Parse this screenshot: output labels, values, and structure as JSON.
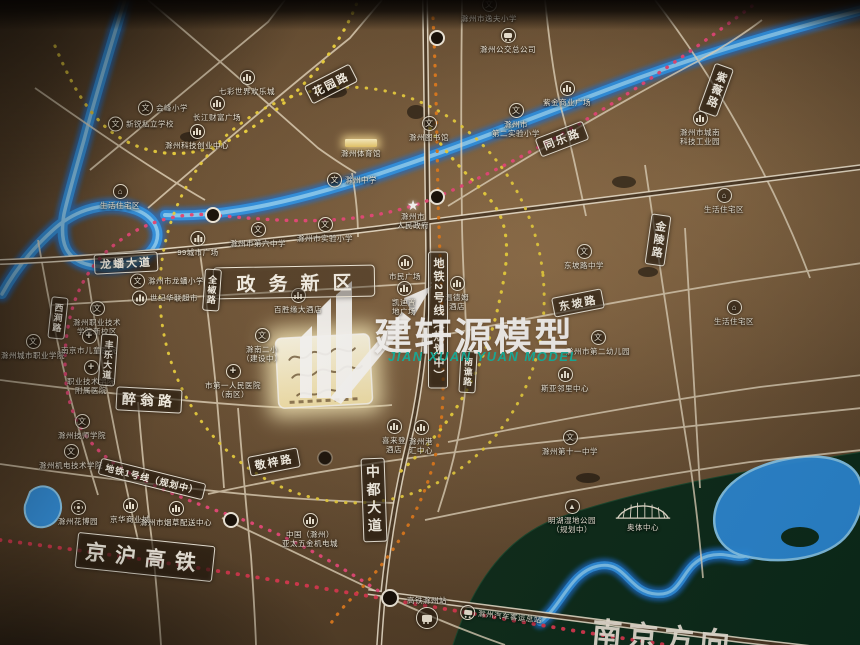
{
  "watermark": {
    "title": "建轩源模型",
    "subtitle": "JIAN XUAN YUAN MODEL",
    "accent_color": "#14b5a2"
  },
  "map": {
    "district_label": "政务新区",
    "direction_label": "南京方向",
    "colors": {
      "board_brown": "#6b5238",
      "road_line": "#eee2c9",
      "river_blue": "#2f93e6",
      "park_green": "#0d2d1c",
      "metro_yellow": "#ecd23e",
      "rail_pink": "#e8487a",
      "hsr_red": "#d93850",
      "line_orange": "#e07b1e",
      "glow_parcel": "#fff3cf"
    },
    "road_labels": [
      {
        "text": "花园路",
        "x": 331,
        "y": 84,
        "rot": -27,
        "dir": "h",
        "size": "m"
      },
      {
        "text": "龙蟠大道",
        "x": 126,
        "y": 263,
        "rot": -3,
        "dir": "h",
        "size": "m"
      },
      {
        "text": "同乐路",
        "x": 562,
        "y": 139,
        "rot": -21,
        "dir": "h",
        "size": "m"
      },
      {
        "text": "紫薇路",
        "x": 716,
        "y": 90,
        "rot": 20,
        "dir": "v",
        "size": "m"
      },
      {
        "text": "西涧路",
        "x": 58,
        "y": 318,
        "rot": 6,
        "dir": "v",
        "size": "s"
      },
      {
        "text": "全椒路",
        "x": 212,
        "y": 290,
        "rot": 4,
        "dir": "v",
        "size": "s"
      },
      {
        "text": "丰乐大道",
        "x": 108,
        "y": 360,
        "rot": 4,
        "dir": "v",
        "size": "s"
      },
      {
        "text": "醉翁路",
        "x": 149,
        "y": 400,
        "rot": 3,
        "dir": "h",
        "size": "l"
      },
      {
        "text": "金陵路",
        "x": 658,
        "y": 240,
        "rot": 8,
        "dir": "v",
        "size": "m"
      },
      {
        "text": "东坡路",
        "x": 578,
        "y": 303,
        "rot": -11,
        "dir": "h",
        "size": "m"
      },
      {
        "text": "南谯路",
        "x": 468,
        "y": 372,
        "rot": 3,
        "dir": "v",
        "size": "s"
      },
      {
        "text": "中都大道",
        "x": 374,
        "y": 500,
        "rot": -2,
        "dir": "v",
        "size": "l"
      },
      {
        "text": "敬梓路",
        "x": 274,
        "y": 462,
        "rot": -11,
        "dir": "h",
        "size": "m"
      },
      {
        "text": "京沪高铁",
        "x": 145,
        "y": 557,
        "rot": 6,
        "dir": "h",
        "size": "xl"
      },
      {
        "text": "地铁1号线（规划中）",
        "x": 152,
        "y": 479,
        "rot": 14,
        "dir": "h",
        "size": "s"
      },
      {
        "text": "地铁2号线（规划中）",
        "x": 438,
        "y": 320,
        "rot": 0,
        "dir": "v",
        "size": "m"
      }
    ],
    "pois": [
      {
        "type": "school",
        "layout": "row",
        "x": 138,
        "y": 108,
        "lines": [
          "会峰小学"
        ]
      },
      {
        "type": "school",
        "layout": "row",
        "x": 108,
        "y": 124,
        "lines": [
          "新锐私立学校"
        ]
      },
      {
        "type": "biz",
        "layout": "col",
        "x": 247,
        "y": 70,
        "lines": [
          "七彩世界欢乐城"
        ]
      },
      {
        "type": "biz",
        "layout": "col",
        "x": 217,
        "y": 96,
        "lines": [
          "长江财富广场"
        ]
      },
      {
        "type": "biz",
        "layout": "col",
        "x": 197,
        "y": 124,
        "lines": [
          "滁州科技创业中心"
        ]
      },
      {
        "type": "res",
        "layout": "col",
        "x": 120,
        "y": 184,
        "lines": [
          "生活住宅区"
        ]
      },
      {
        "type": "school",
        "layout": "col",
        "x": 489,
        "y": -3,
        "lines": [
          "滁州市逸夫小学"
        ]
      },
      {
        "type": "bus",
        "layout": "col",
        "x": 508,
        "y": 28,
        "lines": [
          "滁州公交总公司"
        ]
      },
      {
        "type": "biz",
        "layout": "col",
        "x": 567,
        "y": 81,
        "lines": [
          "紫金商业广场"
        ]
      },
      {
        "type": "school",
        "layout": "col",
        "x": 516,
        "y": 103,
        "lines": [
          "滁州市",
          "第二实验小学"
        ]
      },
      {
        "type": "factory",
        "layout": "col",
        "x": 700,
        "y": 111,
        "lines": [
          "滁州市城南",
          "科技工业园"
        ]
      },
      {
        "type": "res",
        "layout": "col",
        "x": 724,
        "y": 188,
        "lines": [
          "生活住宅区"
        ]
      },
      {
        "type": "res",
        "layout": "col",
        "x": 734,
        "y": 300,
        "lines": [
          "生活住宅区"
        ]
      },
      {
        "type": "school",
        "layout": "col",
        "x": 429,
        "y": 116,
        "lines": [
          "滁州图书馆"
        ]
      },
      {
        "type": "gym",
        "layout": "col",
        "x": 361,
        "y": 139,
        "lines": [
          "滁州体育馆"
        ]
      },
      {
        "type": "school",
        "layout": "row",
        "x": 327,
        "y": 180,
        "lines": [
          "滁州中学"
        ]
      },
      {
        "type": "school",
        "layout": "col",
        "x": 258,
        "y": 222,
        "lines": [
          "滁州市第六中学"
        ]
      },
      {
        "type": "biz",
        "layout": "col",
        "x": 198,
        "y": 231,
        "lines": [
          "99城市广场"
        ]
      },
      {
        "type": "school",
        "layout": "row",
        "x": 130,
        "y": 281,
        "lines": [
          "滁州市龙蟠小学"
        ]
      },
      {
        "type": "biz",
        "layout": "row",
        "x": 132,
        "y": 298,
        "lines": [
          "世纪华联超市"
        ]
      },
      {
        "type": "biz",
        "layout": "col",
        "x": 298,
        "y": 288,
        "lines": [
          "百胜缘大酒店"
        ]
      },
      {
        "type": "school",
        "layout": "col",
        "x": 325,
        "y": 217,
        "lines": [
          "滁州市实验小学"
        ]
      },
      {
        "type": "gov",
        "layout": "col",
        "x": 413,
        "y": 198,
        "lines": [
          "滁州市",
          "人民政府"
        ]
      },
      {
        "type": "biz",
        "layout": "col",
        "x": 405,
        "y": 255,
        "lines": [
          "市民广场"
        ]
      },
      {
        "type": "biz",
        "layout": "col",
        "x": 404,
        "y": 281,
        "lines": [
          "凯迪置",
          "地广场"
        ]
      },
      {
        "type": "biz",
        "layout": "col",
        "x": 457,
        "y": 276,
        "lines": [
          "温德姆",
          "酒店"
        ]
      },
      {
        "type": "school",
        "layout": "col",
        "x": 584,
        "y": 244,
        "lines": [
          "东坡路中学"
        ]
      },
      {
        "type": "school",
        "layout": "col",
        "x": 598,
        "y": 330,
        "lines": [
          "滁州市第二幼儿园"
        ]
      },
      {
        "type": "biz",
        "layout": "col",
        "x": 565,
        "y": 367,
        "lines": [
          "斯亚邻里中心"
        ]
      },
      {
        "type": "school",
        "layout": "col",
        "x": 262,
        "y": 328,
        "lines": [
          "滁南二小",
          "（建设中）"
        ]
      },
      {
        "type": "hospital",
        "layout": "col",
        "x": 233,
        "y": 364,
        "lines": [
          "市第一人民医院",
          "（南区）"
        ]
      },
      {
        "type": "school",
        "layout": "col",
        "x": 570,
        "y": 430,
        "lines": [
          "滁州第十一中学"
        ]
      },
      {
        "type": "park",
        "layout": "col",
        "x": 572,
        "y": 499,
        "lines": [
          "明湖湿地公园",
          "（规划中）"
        ]
      },
      {
        "type": "stadium",
        "layout": "col",
        "x": 643,
        "y": 498,
        "lines": [
          "奥体中心"
        ]
      },
      {
        "type": "biz",
        "layout": "col",
        "x": 394,
        "y": 419,
        "lines": [
          "喜来登",
          "酒店"
        ]
      },
      {
        "type": "biz",
        "layout": "col",
        "x": 421,
        "y": 420,
        "lines": [
          "滁州港",
          "汇中心"
        ]
      },
      {
        "type": "biz",
        "layout": "col",
        "x": 310,
        "y": 513,
        "lines": [
          "中国（滁州）",
          "亚太五金机电城"
        ]
      },
      {
        "type": "rail",
        "layout": "colrev",
        "x": 427,
        "y": 596,
        "lines": [
          "高铁滁州站"
        ]
      },
      {
        "type": "bus",
        "layout": "row",
        "x": 460,
        "y": 616,
        "rot": 6,
        "lines": [
          "滁州汽车客运总站"
        ]
      },
      {
        "type": "flower",
        "layout": "col",
        "x": 78,
        "y": 500,
        "lines": [
          "滁州花博园"
        ]
      },
      {
        "type": "biz",
        "layout": "col",
        "x": 130,
        "y": 498,
        "lines": [
          "京华商业城"
        ]
      },
      {
        "type": "biz",
        "layout": "col",
        "x": 176,
        "y": 501,
        "lines": [
          "滁州市烟草配送中心"
        ]
      },
      {
        "type": "school",
        "layout": "col",
        "x": 82,
        "y": 414,
        "lines": [
          "滁州技师学院"
        ]
      },
      {
        "type": "school",
        "layout": "col",
        "x": 71,
        "y": 444,
        "lines": [
          "滁州机电技术学院"
        ]
      },
      {
        "type": "school",
        "layout": "col",
        "x": 33,
        "y": 334,
        "lines": [
          "滁州城市职业学院"
        ]
      },
      {
        "type": "school",
        "layout": "col",
        "x": 97,
        "y": 301,
        "lines": [
          "滁州职业技术",
          "学院新校区"
        ]
      },
      {
        "type": "hospital",
        "layout": "col",
        "x": 89,
        "y": 329,
        "lines": [
          "南京市儿童医院"
        ]
      },
      {
        "type": "hospital",
        "layout": "col",
        "x": 91,
        "y": 360,
        "lines": [
          "职业技术学院",
          "附属医院"
        ]
      }
    ]
  }
}
